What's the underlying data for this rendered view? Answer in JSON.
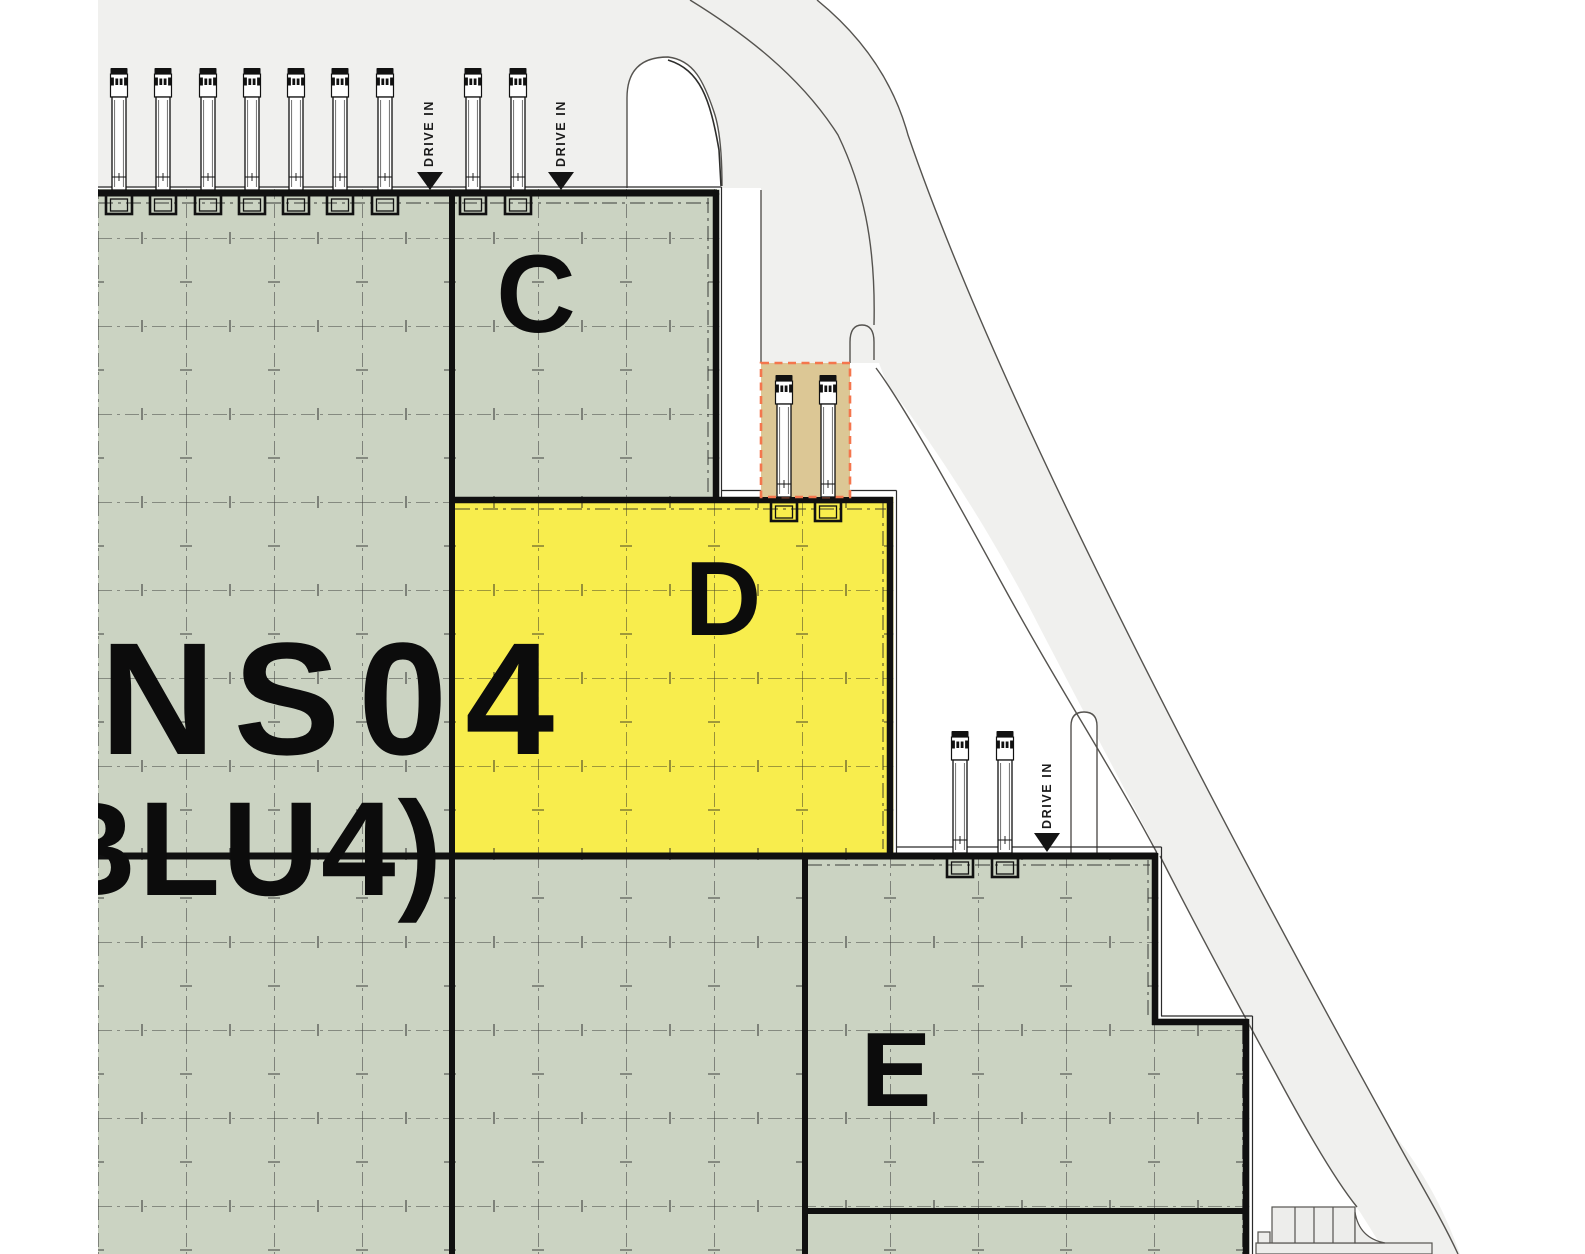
{
  "plan": {
    "kind": "industrial site plan",
    "main_label": "NS04",
    "sub_label": "(BLU4)",
    "drive_in_label": "DRIVE IN",
    "units": [
      {
        "id": "C",
        "label": "C",
        "state": "available"
      },
      {
        "id": "D",
        "label": "D",
        "state": "highlighted"
      },
      {
        "id": "E",
        "label": "E",
        "state": "available"
      }
    ]
  },
  "colors": {
    "pavement": "#f0f0ee",
    "yard": "#ffffff",
    "building_green": "#cbd3c2",
    "unit_d_yellow": "#f8ed4d",
    "dock_zone_tan": "#dcc795",
    "dock_zone_border": "#f4764d",
    "wall": "#101010",
    "road_line": "#55534f",
    "label": "#0c0c0c"
  },
  "truck_groups": [
    {
      "name": "north-docks-left",
      "wall_y": 190,
      "xs": [
        119,
        163,
        208,
        252,
        296,
        340,
        385
      ]
    },
    {
      "name": "north-docks-unit-c",
      "wall_y": 190,
      "xs": [
        473,
        518
      ]
    },
    {
      "name": "unit-d-docks-highlighted",
      "wall_y": 497,
      "xs": [
        784,
        828
      ]
    },
    {
      "name": "unit-e-docks",
      "wall_y": 853,
      "xs": [
        960,
        1005
      ]
    }
  ],
  "drive_in_markers": [
    {
      "cx": 429,
      "apex_y": 190
    },
    {
      "cx": 561,
      "apex_y": 190
    },
    {
      "cx": 1047,
      "apex_y": 852
    }
  ]
}
